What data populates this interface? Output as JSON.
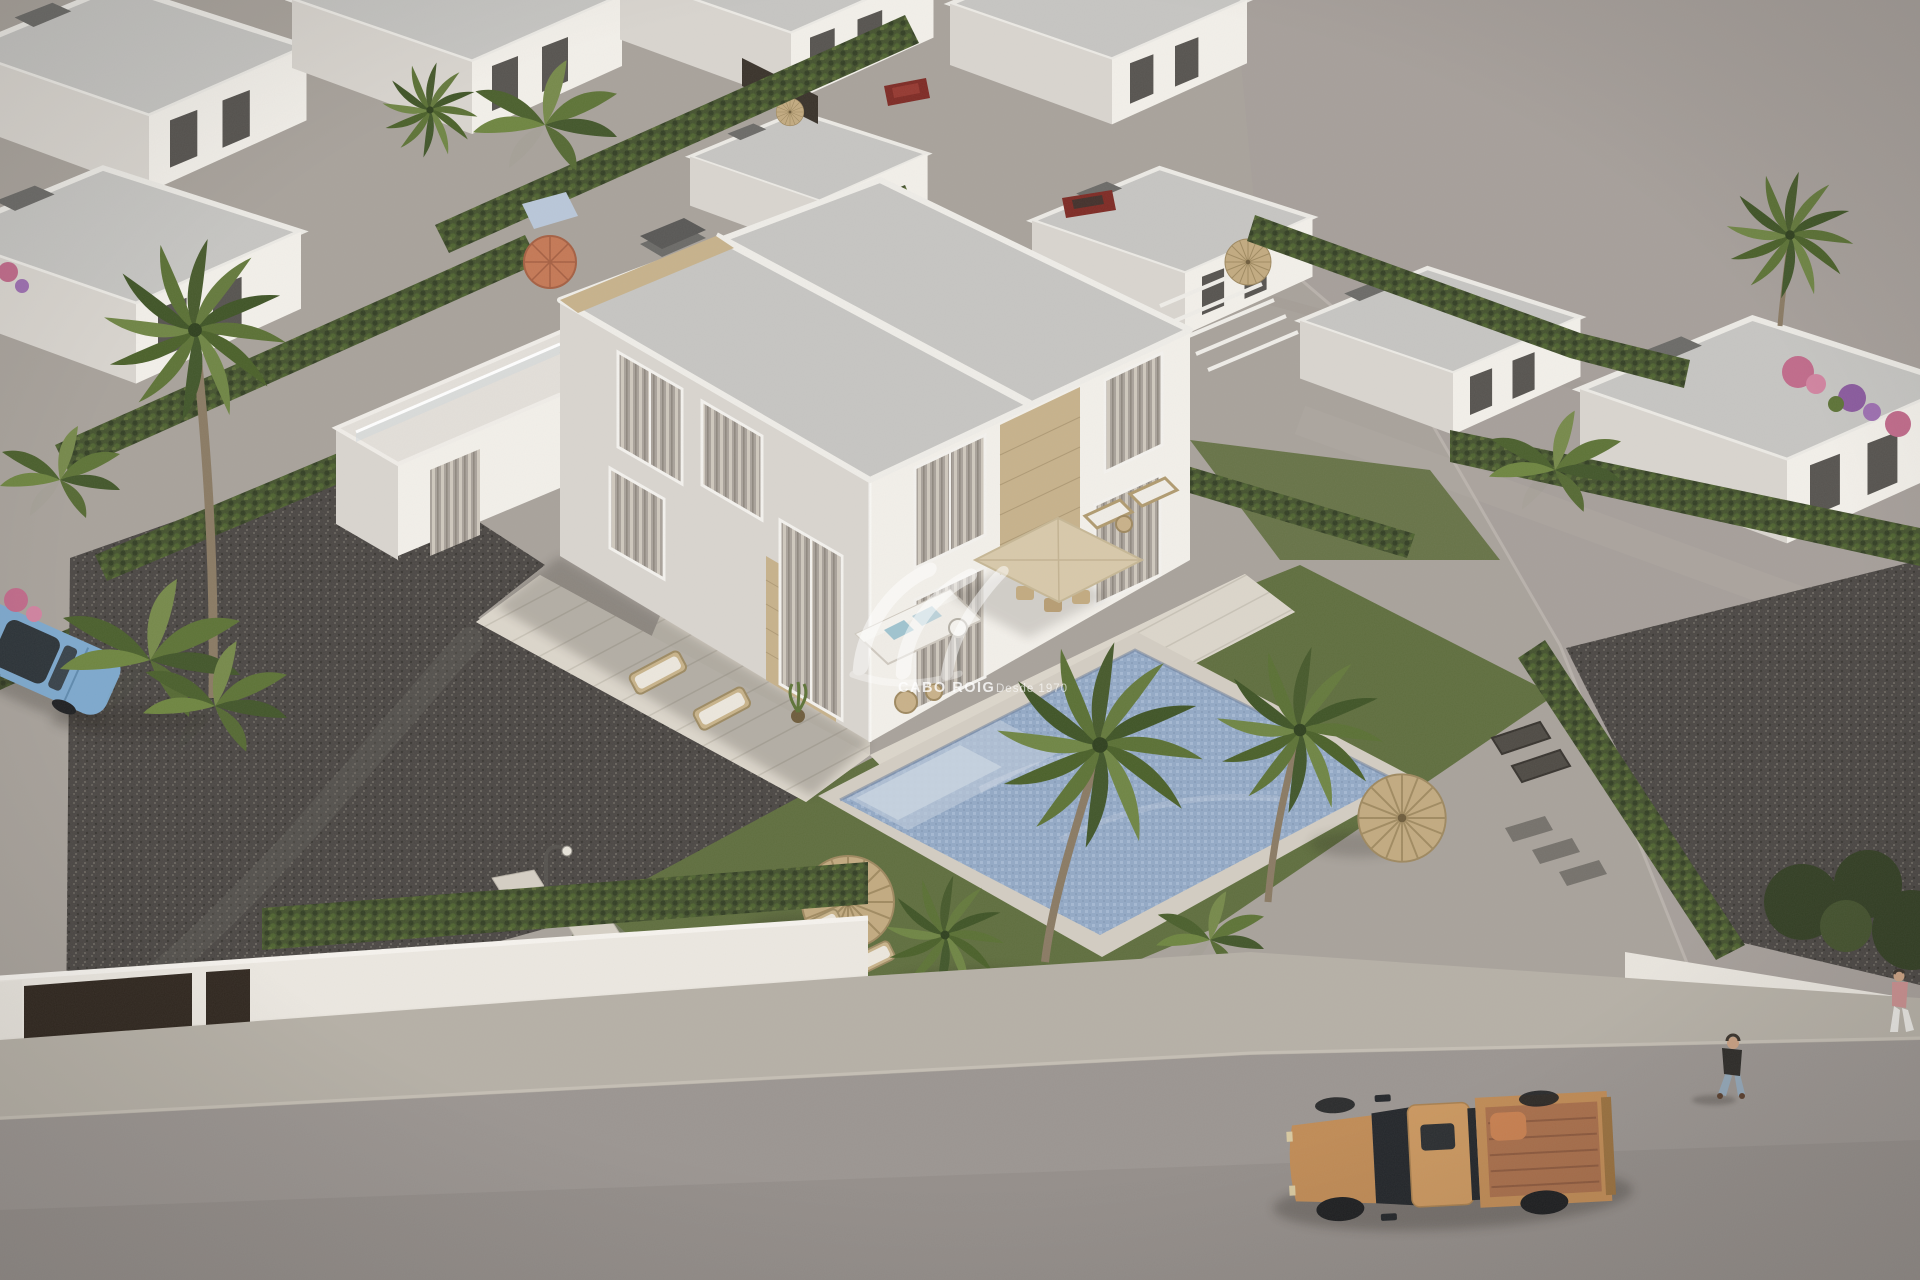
{
  "page": {
    "type": "3D architectural aerial render photograph (no UI chrome)",
    "width_px": 1920,
    "height_px": 1280
  },
  "watermark": {
    "brand": "CABO ROIG",
    "tagline": "Desde 1970",
    "logo": "wave-monogram",
    "color": "#ffffff"
  },
  "palette": {
    "ground": "#a8a29b",
    "lot": "#a69f9a",
    "road": "#9b9591",
    "sidewalk": "#b6b0a6",
    "wall-lit": "#f3f0ea",
    "wall-shade": "#d9d5cf",
    "wall-dark": "#c7c3bd",
    "roof": "#c6c5c2",
    "stone": "#c7b28b",
    "stone-dark": "#a8936f",
    "lawn": "#5f6e3e",
    "lawn-shade": "#4c5a33",
    "hedge": "#44522e",
    "hedge-dark": "#333f24",
    "hedge-light": "#5c6c38",
    "palm": "#4e6330",
    "palm-light": "#6d8142",
    "pool-water": "#93a9c6",
    "pool-light": "#b9c7d9",
    "pool-deck": "#d3cdc2",
    "terrace": "#dcd6cb",
    "curtain": "#a9a29a",
    "curtain-light": "#cfc8bd",
    "window-dark": "#56534f",
    "parasol-wicker": "#c2aa80",
    "parasol-cream": "#d8c9aa",
    "parasol-orange": "#c47855",
    "truck-body": "#c08b55",
    "truck-bed": "#a96f4b",
    "truck-dark": "#25282b",
    "car-blue": "#7da8cd",
    "car-red": "#7e2a24",
    "skin": "#caa183",
    "jeans": "#93a7b8",
    "jacket": "#2e2c29"
  },
  "scene": {
    "setting": "aerial view of a modern Mediterranean residential development of white villas",
    "main_building": {
      "type": "two-storey semi-detached villa, flat grey roof with chimney",
      "walls": "white with beige natural-stone cladding accents",
      "features": [
        "curtained floor-to-ceiling windows",
        "glass balustrade roof terrace",
        "paved sun terraces"
      ]
    },
    "pool": "long blue mosaic pool with pale stone deck and corner steps",
    "garden": {
      "lawn": true,
      "dark_gravel_yard": true,
      "stepping_stones": true,
      "wicker_parasols": 3,
      "square_cream_dining_parasol": 1,
      "orange_parasol_background": 1,
      "sun_loungers": 6,
      "outdoor_sofa": "white corner sofa with light-blue cushions",
      "street_lamp": true
    },
    "vegetation": [
      "palm trees",
      "cypress hedges",
      "banana plants",
      "pink and purple flowering shrubs"
    ],
    "street": {
      "road": "grey asphalt along bottom edge",
      "sidewalk": "light speckled pavement",
      "perimeter_wall": "white wall with dark brown entrance gates"
    },
    "vehicles": [
      {
        "type": "pickup truck",
        "color": "sand orange",
        "location": "road, bottom right"
      },
      {
        "type": "sedan",
        "color": "light blue",
        "location": "parked, left edge"
      },
      {
        "type": "car",
        "color": "dark red",
        "location": "background lane, top"
      },
      {
        "type": "car",
        "color": "dark red",
        "location": "background lane, centre"
      }
    ],
    "people": [
      {
        "description": "pedestrian in dark jacket and blue jeans walking on the road, right side"
      },
      {
        "description": "second pedestrian partially visible at the right edge"
      }
    ],
    "background": {
      "villa_rows": "rows of identical white flat-roof villas, upper left and right",
      "vacant_plot": "large empty grey-brown ground, upper right"
    }
  }
}
